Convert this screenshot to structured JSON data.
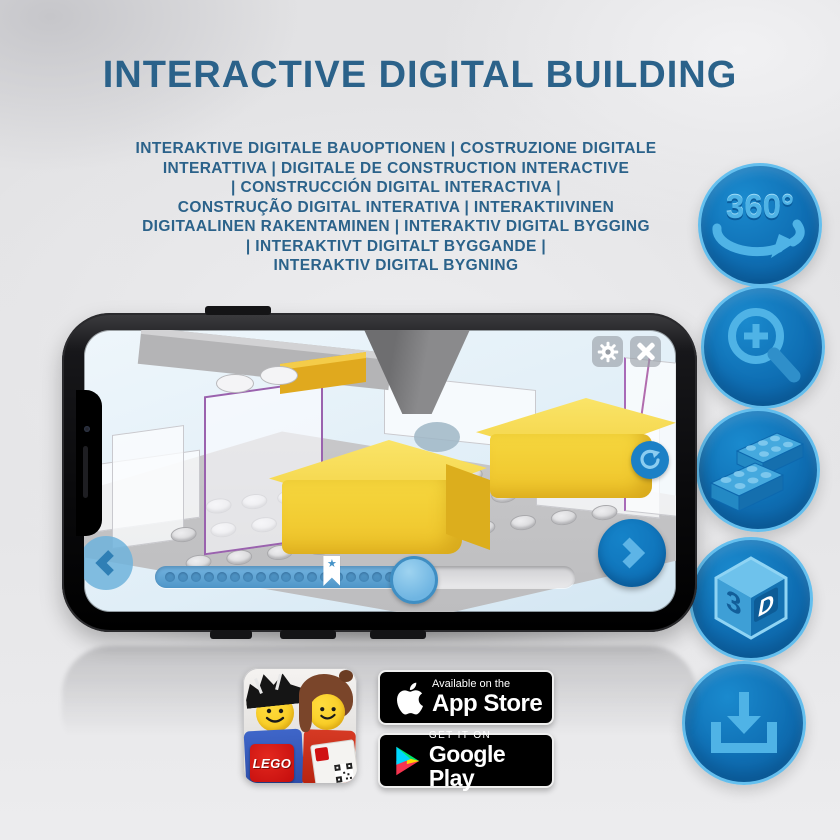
{
  "colors": {
    "accent_blue": "#0f6fb4",
    "light_blue": "#4fb3e6",
    "heading": "#2b628a",
    "lego_yellow": "#f2cd33",
    "badge_bg": "#000000"
  },
  "header": {
    "title": "INTERACTIVE DIGITAL BUILDING",
    "subtitle": "INTERAKTIVE DIGITALE BAUOPTIONEN | COSTRUZIONE DIGITALE\nINTERATTIVA | DIGITALE DE CONSTRUCTION INTERACTIVE\n| CONSTRUCCIÓN DIGITAL INTERACTIVA |\nCONSTRUÇÃO DIGITAL INTERATIVA | INTERAKTIIVINEN\nDIGITAALINEN RAKENTAMINEN | INTERAKTIV DIGITAL BYGGING\n| INTERAKTIVT DIGITALT BYGGANDE |\nINTERAKTIV DIGITAL BYGNING"
  },
  "feature_icons": {
    "rotate_label": "360°",
    "cube_left_label": "3",
    "cube_right_label": "D",
    "names": [
      "360-rotate",
      "zoom-in",
      "brick",
      "3d-view",
      "download"
    ]
  },
  "phone": {
    "progress": {
      "dot_count": 18,
      "fill_percent": 61,
      "bookmark_percent": 42,
      "thumb_percent": 61,
      "bookmark_star": "★"
    }
  },
  "store": {
    "app_store": {
      "line1": "Available on the",
      "line2": "App Store"
    },
    "google_play": {
      "line1": "GET IT ON",
      "line2": "Google Play"
    },
    "app_icon_logo": "LEGO"
  }
}
